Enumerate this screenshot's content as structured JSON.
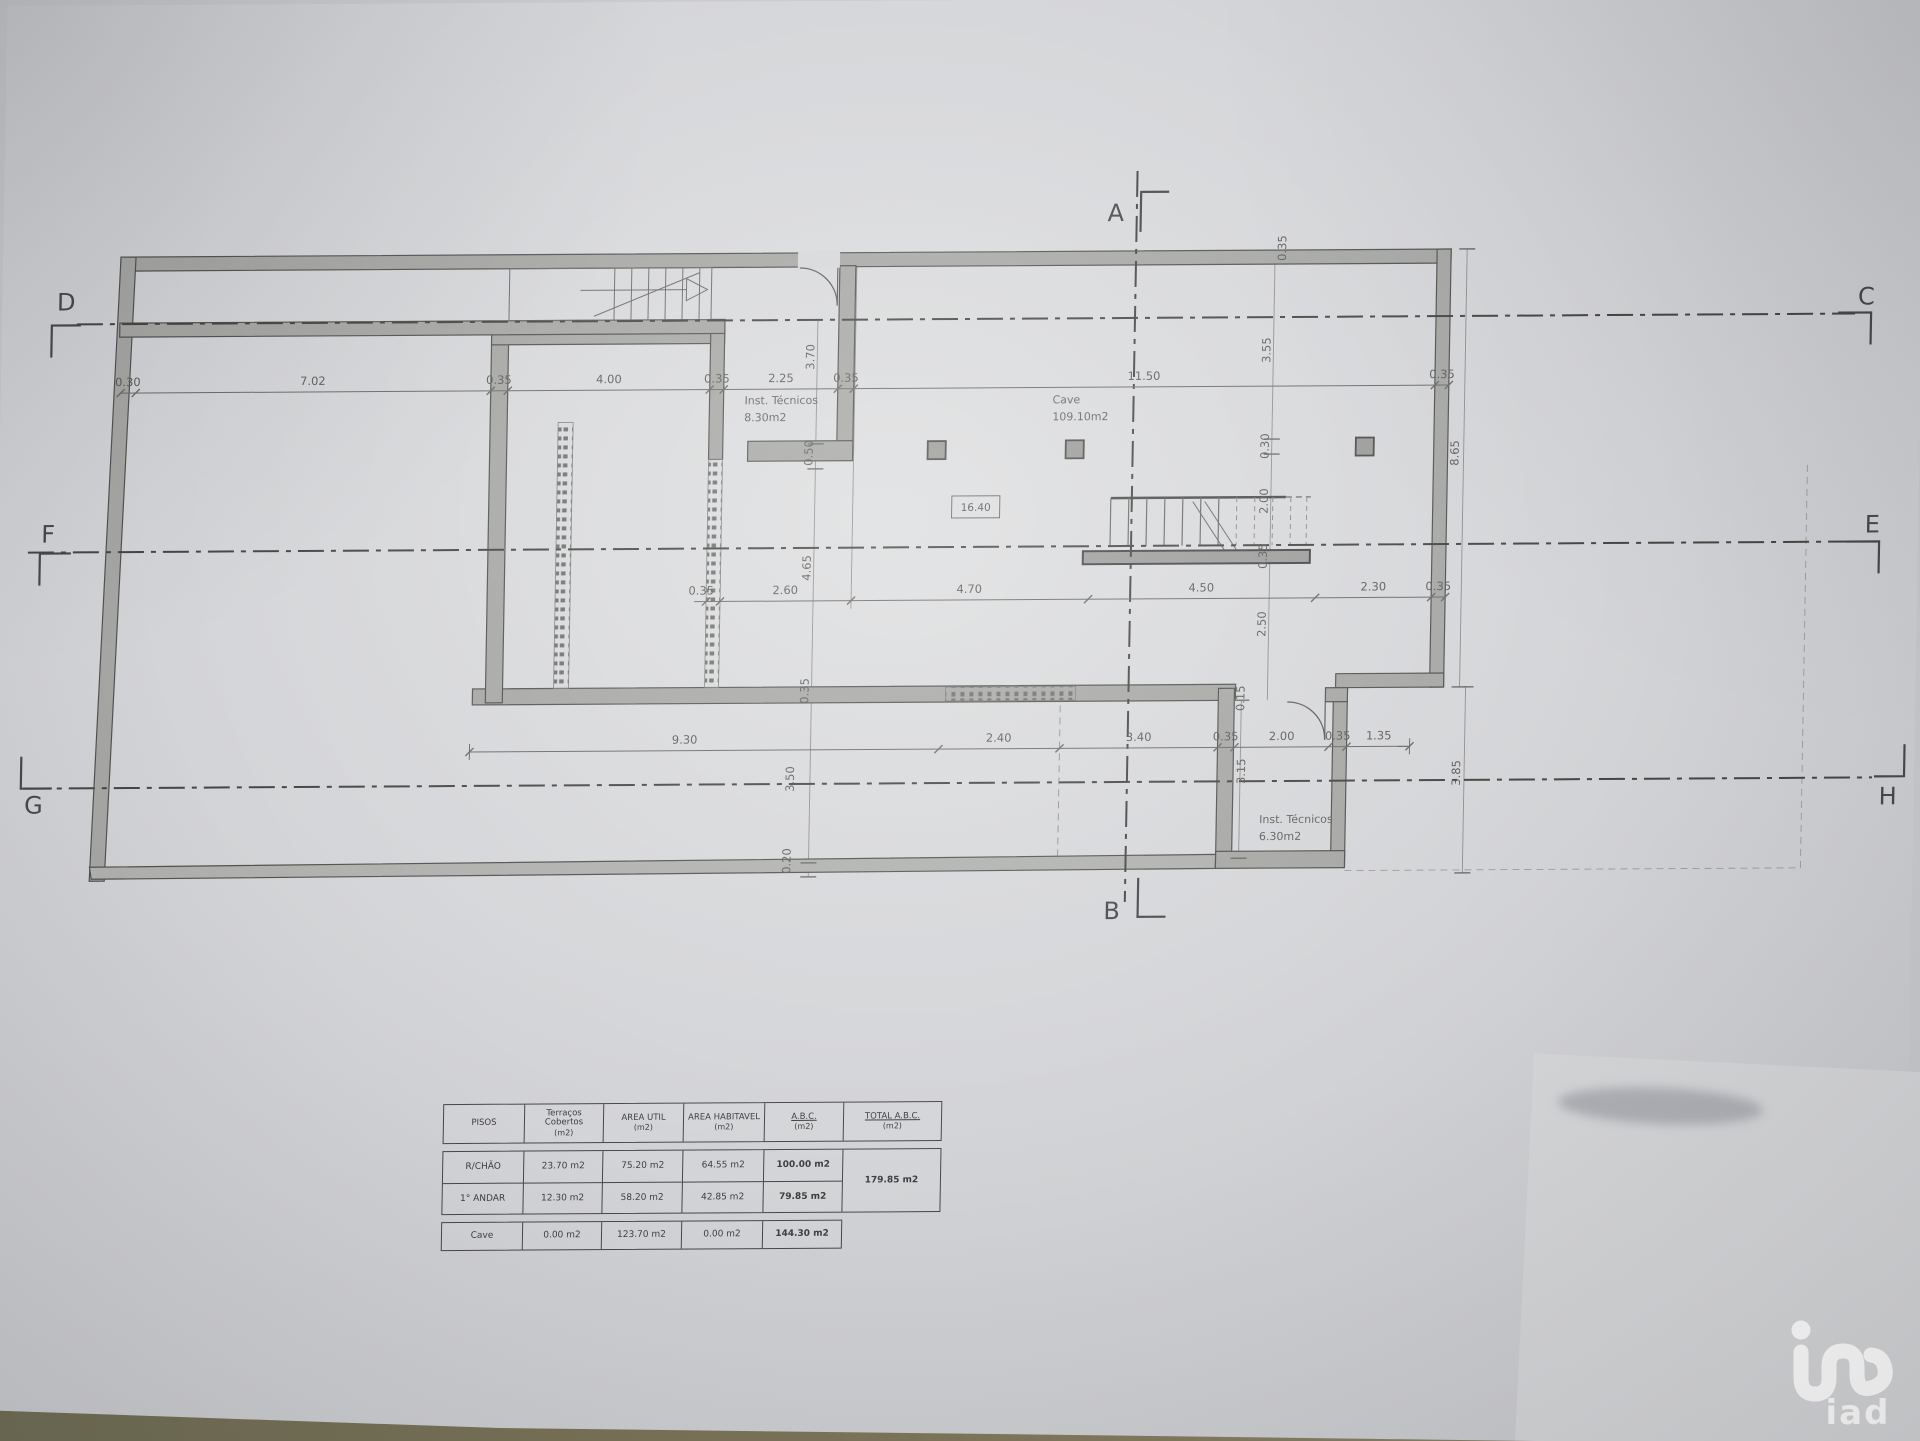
{
  "photo": {
    "colors": {
      "paper": "#d3d4d7",
      "wall": "#a6a6a4",
      "ink": "#4a4a48",
      "table_edge": "#77745a"
    }
  },
  "plan": {
    "markers": {
      "top": "A",
      "bottom": "B",
      "right_top": "C",
      "left_top": "D",
      "right_mid": "E",
      "left_mid": "F",
      "left_bottom": "G",
      "right_bottom": "H"
    },
    "labels": {
      "room1_name": "Inst. Técnicos",
      "room1_area": "8.30m2",
      "cave_name": "Cave",
      "cave_area": "109.10m2",
      "room2_name": "Inst. Técnicos",
      "room2_area": "6.30m2",
      "level": "16.40"
    },
    "dims": {
      "top": [
        "0.30",
        "7.02",
        "0.35",
        "4.00",
        "0.35",
        "2.25",
        "0.35",
        "11.50",
        "0.35"
      ],
      "mid": [
        "0.35",
        "2.60",
        "4.70",
        "4.50",
        "2.30",
        "0.35"
      ],
      "bottom": [
        "9.30",
        "2.40",
        "3.40",
        "0.35",
        "2.00",
        "0.35",
        "1.35"
      ],
      "vleft": [
        "3.70",
        "0.50",
        "4.65",
        "0.35",
        "3.50",
        "0.20"
      ],
      "vcenter": [
        "0.35",
        "3.55",
        "0.30",
        "2.00",
        "0.35",
        "2.50"
      ],
      "vright": [
        "8.65",
        "3.85"
      ],
      "vinner_right": [
        "0.15",
        "3.15"
      ]
    }
  },
  "areas_table": {
    "headers": [
      [
        "PISOS",
        ""
      ],
      [
        "Terraços Cobertos",
        "(m2)"
      ],
      [
        "AREA UTIL",
        "(m2)"
      ],
      [
        "AREA HABITAVEL",
        "(m2)"
      ],
      [
        "A.B.C.",
        "(m2)"
      ],
      [
        "TOTAL A.B.C.",
        "(m2)"
      ]
    ],
    "rows": [
      {
        "piso": "R/CHÃO",
        "terracos": "23.70 m2",
        "util": "75.20 m2",
        "habitavel": "64.55 m2",
        "abc": "100.00 m2"
      },
      {
        "piso": "1° ANDAR",
        "terracos": "12.30 m2",
        "util": "58.20 m2",
        "habitavel": "42.85 m2",
        "abc": "79.85 m2"
      }
    ],
    "total_abc": "179.85 m2",
    "cave_row": {
      "piso": "Cave",
      "terracos": "0.00 m2",
      "util": "123.70 m2",
      "habitavel": "0.00 m2",
      "abc": "144.30 m2"
    }
  },
  "watermark": {
    "logo_text": "iad"
  }
}
